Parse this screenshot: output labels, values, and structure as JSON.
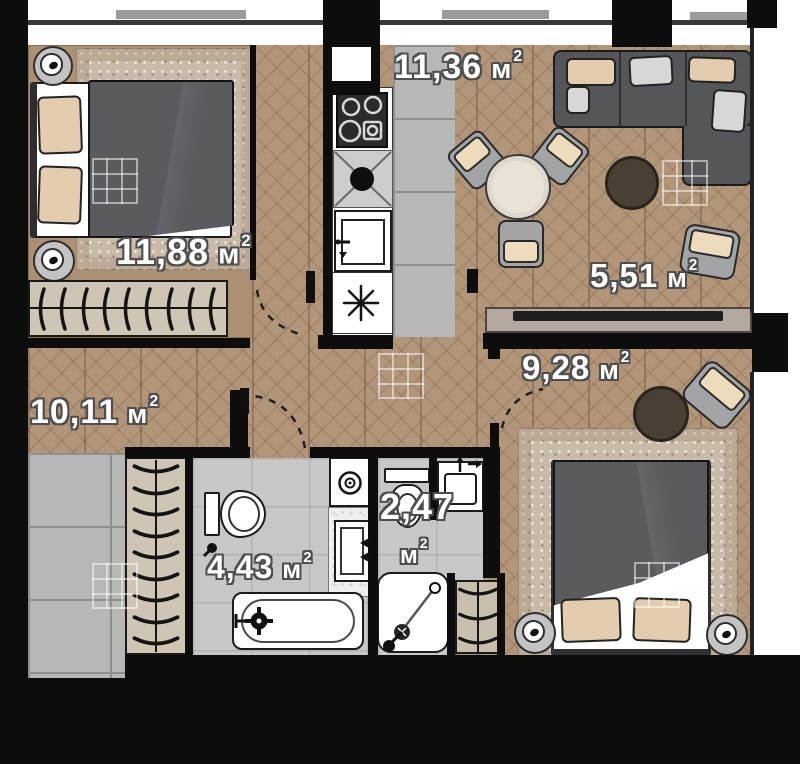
{
  "plan": {
    "type": "apartment-floor-plan",
    "unit_suffix": "м²",
    "rooms": [
      {
        "id": "bedroom-1",
        "area_value": "11,88",
        "area_unit": "м",
        "area_sup": "2"
      },
      {
        "id": "kitchen-dining",
        "area_value": "11,36",
        "area_unit": "м",
        "area_sup": "2"
      },
      {
        "id": "living-zone",
        "area_value": "5,51",
        "area_unit": "м",
        "area_sup": "2"
      },
      {
        "id": "hallway",
        "area_value": "9,28",
        "area_unit": "м",
        "area_sup": "2"
      },
      {
        "id": "corridor",
        "area_value": "10,11",
        "area_unit": "м",
        "area_sup": "2"
      },
      {
        "id": "bathroom",
        "area_value": "4,43",
        "area_unit": "м",
        "area_sup": "2"
      },
      {
        "id": "shower-wc",
        "area_value": "2,47",
        "area_unit": "м",
        "area_sup": "2"
      }
    ],
    "colors": {
      "wall": "#0d0d0d",
      "wood_floor": "#b2967a",
      "tile_gray": "#b7b7b8",
      "tile_light": "#c7c7c8",
      "carpet": "#c9bbaa",
      "exterior_bar": "#9b9b9b",
      "sofa": "#545659",
      "duvet": "#595b5e",
      "pillow_beige": "#e4cdaf",
      "pouf_brown": "#4a3f34",
      "table": "#e9e3d7",
      "label_text": "#ffffff",
      "label_outline": "#4e4e4e"
    },
    "icons": [
      "stove-icon",
      "sink-icon",
      "dishwasher-icon",
      "ceiling-light-icon",
      "washing-machine-icon",
      "toilet-icon",
      "bathtub-icon",
      "shower-icon",
      "washbasin-icon",
      "hanger-icon",
      "door-swing-icon"
    ]
  }
}
